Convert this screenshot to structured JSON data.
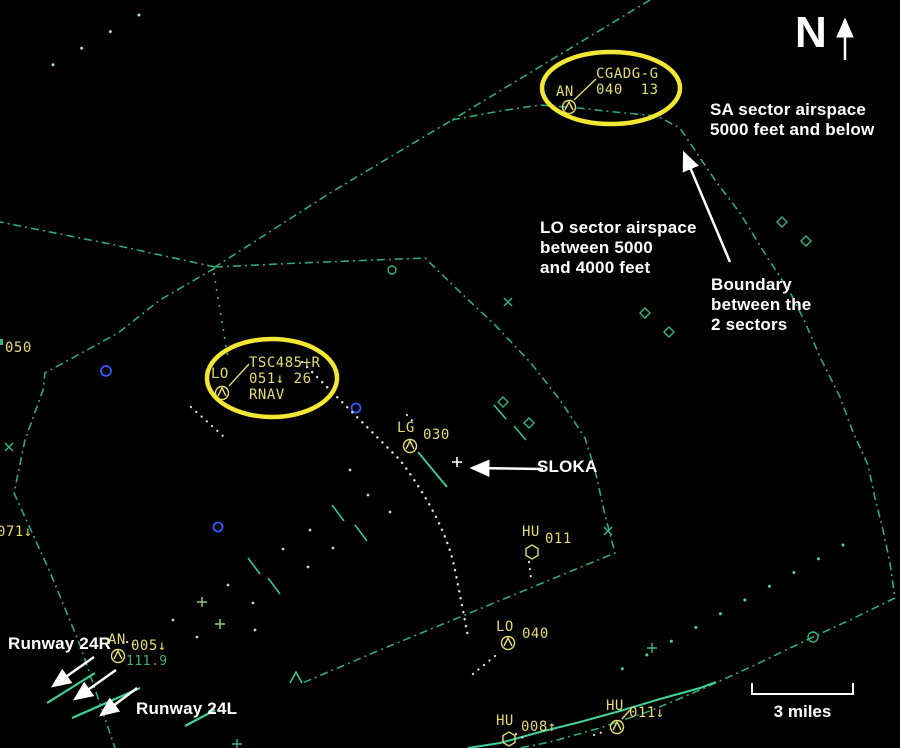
{
  "compass": {
    "letter": "N"
  },
  "scale": {
    "label": "3 miles"
  },
  "annotations": {
    "sa_sector": "SA sector airspace\n5000 feet and below",
    "lo_sector": "LO sector airspace\nbetween 5000\nand 4000 feet",
    "boundary": "Boundary\nbetween the\n2 sectors",
    "sloka": "SLOKA",
    "runway_24r": "Runway 24R",
    "runway_24l": "Runway 24L"
  },
  "aircraft": [
    {
      "callsign": "AN",
      "datablock": "CGADG-G\n040  13"
    },
    {
      "callsign": "LO",
      "datablock": "TSC485+R\n051↓ 26\nRNAV"
    },
    {
      "callsign": "LG",
      "altitude": "030"
    },
    {
      "callsign": "HU",
      "altitude": "011"
    },
    {
      "callsign": "LO",
      "altitude": "040"
    },
    {
      "callsign": "AN",
      "altitude": "005↓",
      "frequency": "111.9"
    },
    {
      "callsign": "HU",
      "altitude": "008↑"
    },
    {
      "callsign": "HU",
      "altitude": "011↓"
    }
  ],
  "edge_labels": {
    "left_upper": "050",
    "left_lower": "071↓"
  },
  "colors": {
    "boundary_green": "#2fa87c",
    "bright_teal": "#3ed29c",
    "label_yellow": "#e4dc72",
    "highlight_yellow": "#f2e732",
    "annotation_white": "#ffffff",
    "frequency_green": "#3db37a",
    "target_blue": "#2e5bff"
  }
}
